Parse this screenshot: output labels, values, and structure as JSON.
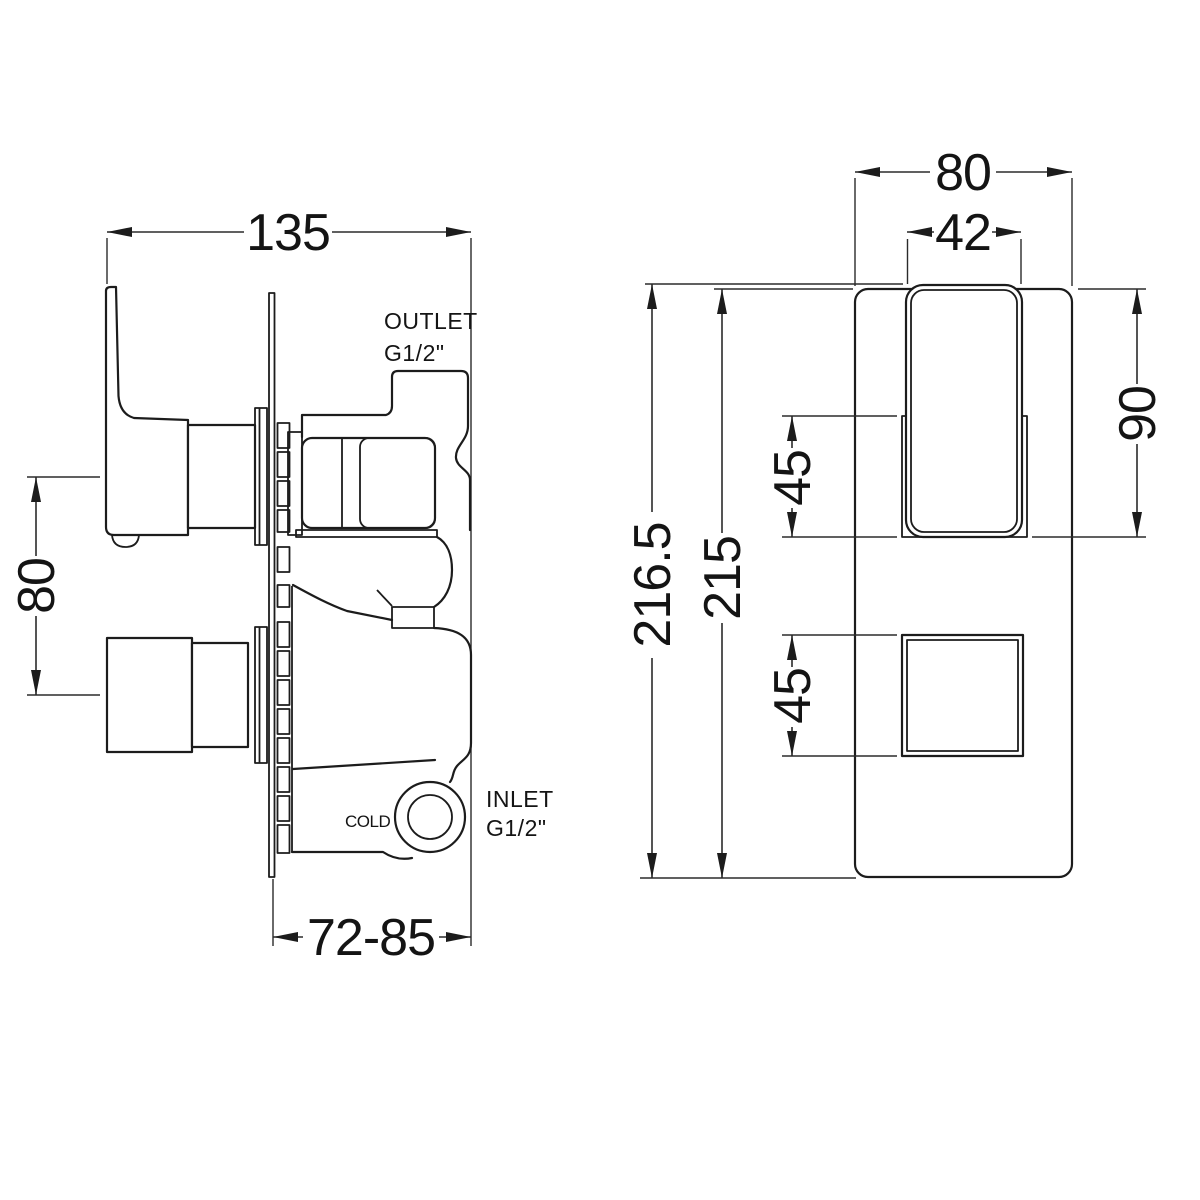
{
  "drawing": {
    "type": "technical-dimension-drawing",
    "subject": "concealed twin thermostatic shower valve",
    "colors": {
      "line": "#1c1c1c",
      "background": "#ffffff"
    },
    "side_view": {
      "dim_width": "135",
      "dim_handle_spacing": "80",
      "dim_depth_range": "72-85",
      "outlet_label": "OUTLET",
      "outlet_thread": "G1/2\"",
      "inlet_label": "INLET",
      "inlet_thread": "G1/2\"",
      "cold_label": "COLD"
    },
    "front_view": {
      "dim_plate_width": "80",
      "dim_handle_width": "42",
      "dim_overall_height": "216.5",
      "dim_plate_height": "215",
      "dim_handle_height": "90",
      "dim_handle_opening": "45",
      "dim_lower_control_size": "45"
    }
  }
}
